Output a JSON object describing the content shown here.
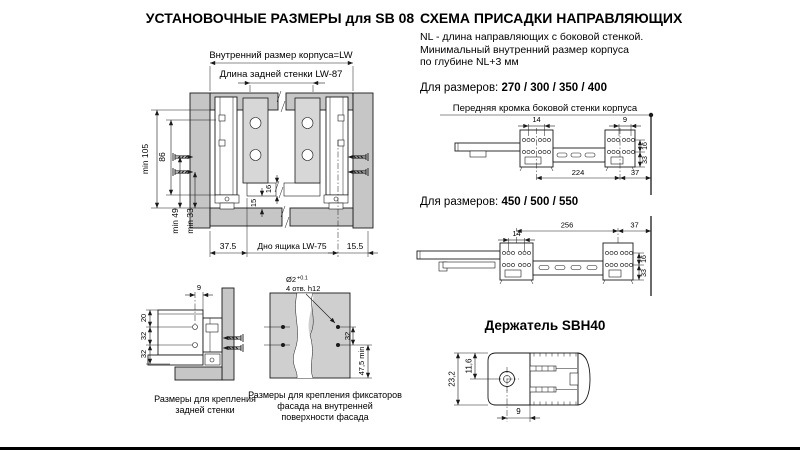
{
  "install": {
    "title": "УСТАНОВОЧНЫЕ РАЗМЕРЫ для SB 08",
    "main": {
      "lw_label": "Внутренний размер корпуса=LW",
      "lw87_label": "Длина задней стенки  LW-87",
      "min105": "min 105",
      "h86": "86",
      "min49": "min 49",
      "min33": "min 33",
      "t16": "16",
      "t15": "15",
      "w375": "37.5",
      "bottom_label": "Дно ящика  LW-75",
      "w155": "15.5"
    },
    "backwall": {
      "w9": "9",
      "h20": "20",
      "h32a": "32",
      "h32b": "32",
      "caption_line1": "Размеры  для крепления",
      "caption_line2": "задней стенки"
    },
    "facade": {
      "hole_d": "Ø2",
      "hole_tol": "+0.1",
      "hole_count": "4 отв. h12",
      "h32": "32",
      "h475": "47,5 min",
      "caption_line1": "Размеры для крепления фиксаторов",
      "caption_line2": "фасада на внутренней",
      "caption_line3": "поверхности фасада"
    }
  },
  "scheme": {
    "title": "СХЕМА ПРИСАДКИ НАПРАВЛЯЮЩИХ",
    "note1": "NL - длина направляющих с боковой стенкой.",
    "note2": "Минимальный внутренний размер корпуса",
    "note3": "по глубине NL+3 мм",
    "sizes1_label": "Для размеров:",
    "sizes1_values": "270 / 300 / 350 / 400",
    "front_edge_label": "Передняя кромка боковой стенки корпуса",
    "dwg1": {
      "w14": "14",
      "w9": "9",
      "w224": "224",
      "w37": "37",
      "h16": "16",
      "h33": "33"
    },
    "sizes2_label": "Для размеров:",
    "sizes2_values": "450 / 500 / 550",
    "dwg2": {
      "w14": "14",
      "w256": "256",
      "w37": "37",
      "h16": "16",
      "h33": "33"
    }
  },
  "holder": {
    "title": "Держатель SBH40",
    "h232": "23,2",
    "h116": "11,6",
    "w9": "9"
  }
}
